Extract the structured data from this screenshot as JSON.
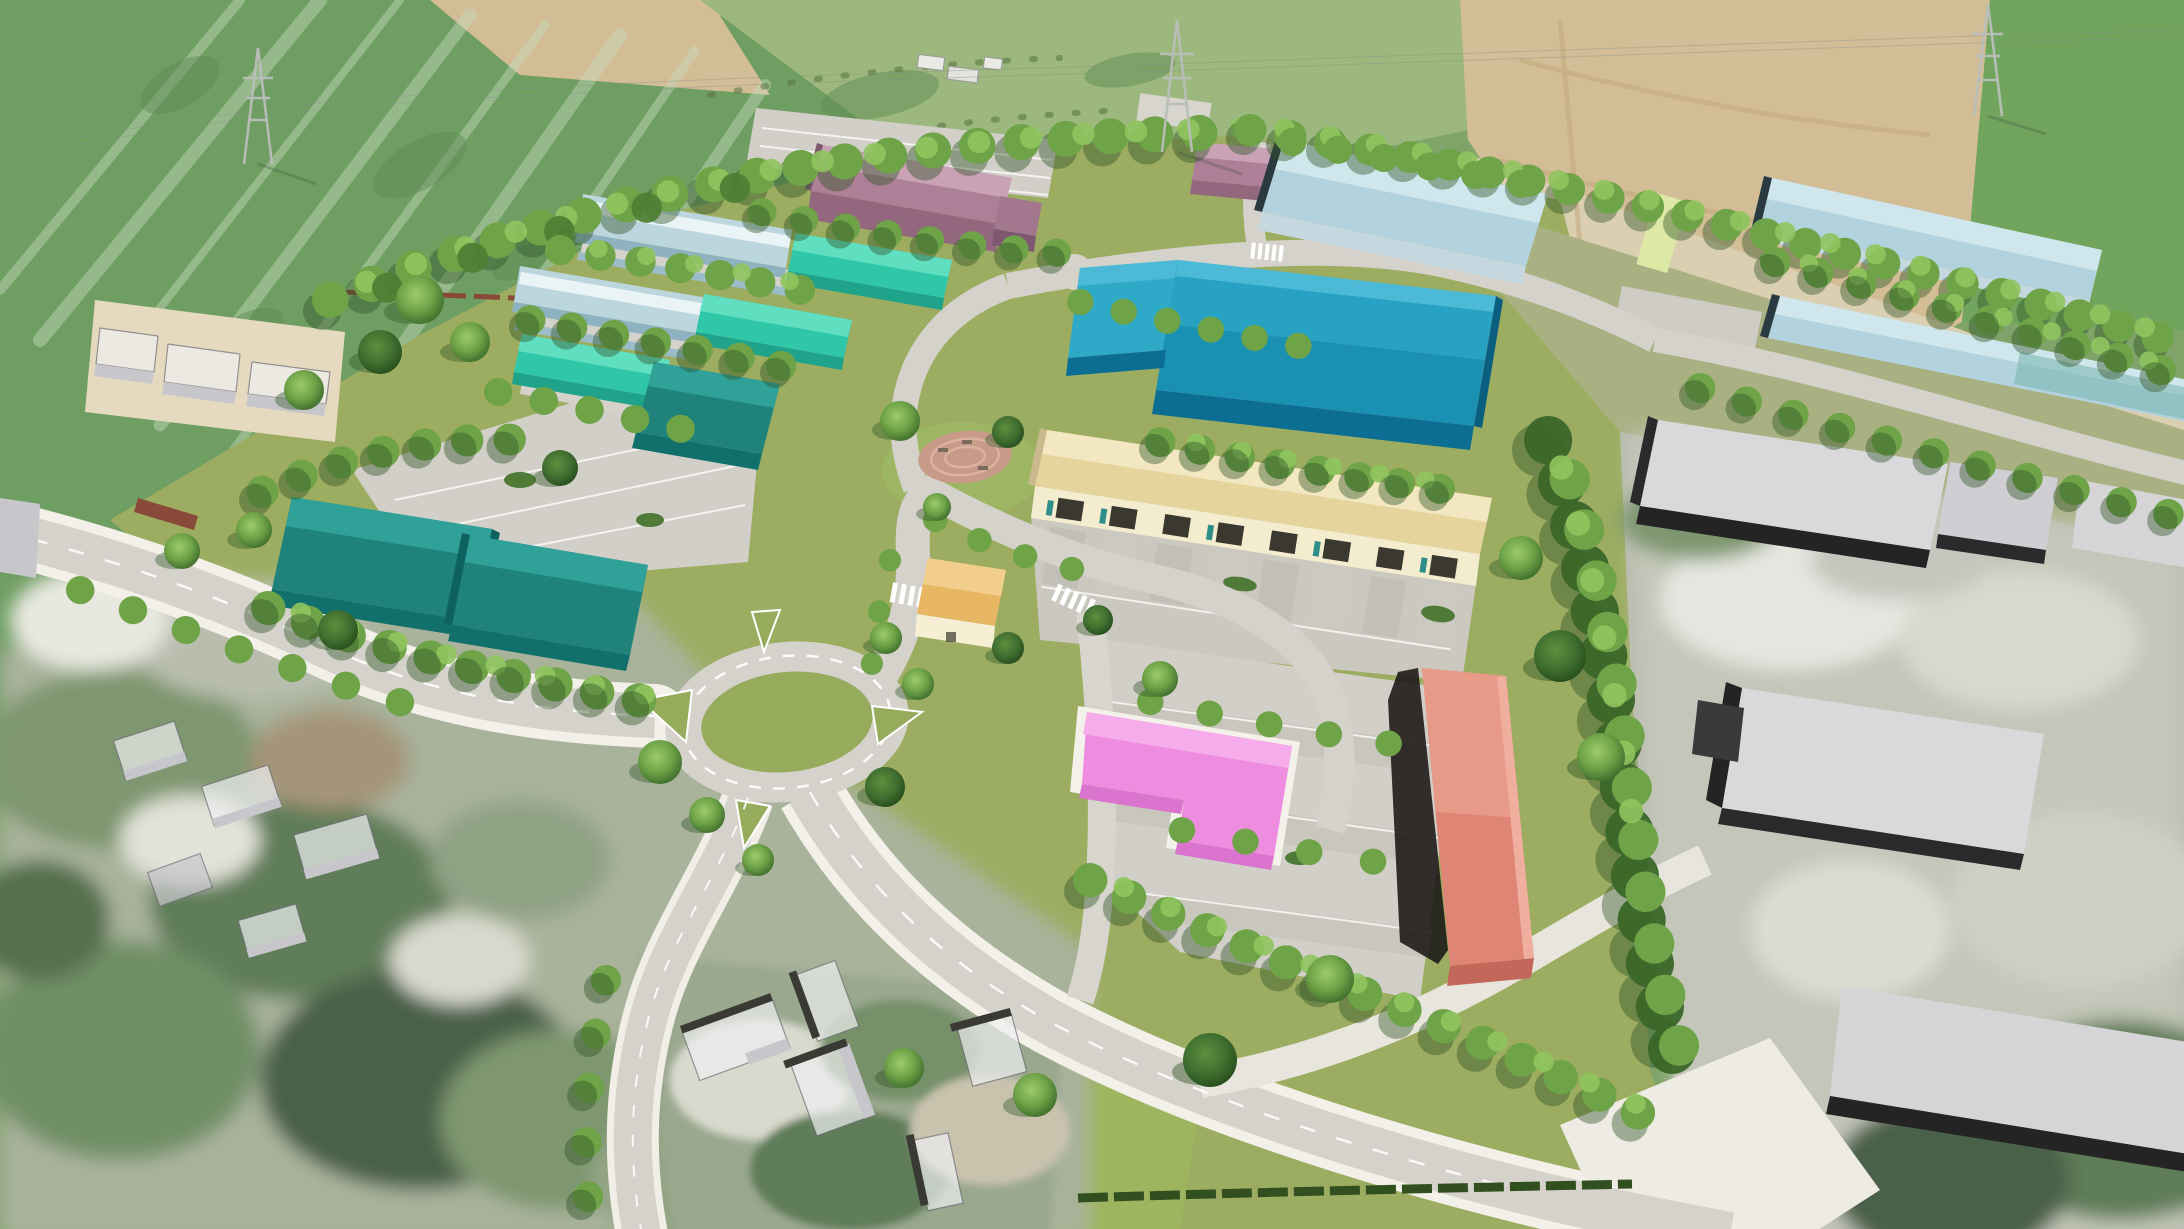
{
  "scene": {
    "type": "aerial-3d-masterplan-visualization",
    "description": "Bird's-eye photomontage of a proposed business park: colour-coded new industrial and commercial buildings set in tree-lined streets with a central roundabout, large parking courts, a circular paved plaza, three electricity pylons in surrounding farmland, existing grey industrial sheds to the east and blurred existing housing to the south-west. No text is rendered in the image.",
    "visible_text": "none"
  },
  "palette": {
    "field_green": "#7FA369",
    "field_emerald": "#6F9E63",
    "field_tan": "#D3BD96",
    "field_pale": "#DBCFB2",
    "field_bright": "#71A55E",
    "meadow": "#9CB87E",
    "site_green": "#9CAD61",
    "lb_ground": "#A9B183",
    "lawn": "#9DB55E",
    "island_green": "#96AC5C",
    "asphalt": "#D5D2CB",
    "asphalt_dark": "#CBC8C0",
    "sidewalk": "#F2F0E8",
    "apron": "#C2BFB6",
    "parking": "#D2CFC8",
    "marking": "#FFFFFF",
    "plaza_brick": "#C79B88",
    "plaza_ring": "#D9B3A2",
    "red_wall": "#8A4A3A",
    "hedge_dark": "#32501F",
    "teal_roof_light": "#2FA198",
    "teal_roof": "#1F837C",
    "teal_face": "#11706B",
    "teal_end": "#0D615E",
    "mint_roof_light": "#5FDFC0",
    "mint_roof": "#2FC7A8",
    "mint_face": "#1FA38A",
    "barrel_roof": "#BCD6DE",
    "barrel_highlight": "#EAF3F5",
    "barrel_face": "#8FB2C0",
    "blue_ridge": "#4CBAD6",
    "blue_roof_upper": "#28A2C2",
    "blue_roof_lower": "#1A90B2",
    "blue_annex": "#2FA9C8",
    "blue_face": "#0C6E93",
    "blue_end": "#0A5F80",
    "mauve_roof_light": "#C9A2B6",
    "mauve_roof": "#AE8098",
    "mauve_face": "#93687E",
    "mauve_end": "#7E5870",
    "mauve_ext": "#A3788E",
    "paleblue_roof_light": "#CFE6EC",
    "paleblue_roof": "#B2D2DD",
    "paleblue_face": "#C6D8DF",
    "paleblue_end": "#2A3A40",
    "paleblue_teal_tint": "#7FB8B4",
    "yellow_roof_light": "#F2E7C0",
    "yellow_roof": "#E5D49C",
    "yellow_face": "#F4ECCF",
    "yellow_end": "#C9B98C",
    "door_dark": "#3B382F",
    "door_teal": "#2E8F8A",
    "gold_roof_light": "#F2CE8C",
    "gold_roof": "#E8B763",
    "gold_face": "#F6EFD3",
    "pink_roof_light": "#F6ACEA",
    "pink_roof": "#EE8CDF",
    "pink_face": "#DA74CF",
    "pink_pad": "#F3F1EA",
    "salmon_roof_light": "#F0AE9E",
    "salmon_roof_upper": "#E89A89",
    "salmon_roof_lower": "#DE8576",
    "salmon_face": "#C4675B",
    "salmon_dark": "#1E1B18",
    "gray_roof": "#D9D9DB",
    "gray_roof2": "#CFCFD3",
    "gray_roof3": "#D5D5D7",
    "gray_dark": "#242424",
    "gray_side": "#2A2A2C",
    "house_roof": "#EFEFF1",
    "house_face": "#C7C7CB",
    "farm_yard": "#E5DAC0",
    "court_lime": "#DCE8A4",
    "pylon_pad": "#D8D5CE"
  },
  "buildings": [
    {
      "id": "teal-twin-west",
      "label": "twin dark-teal warehouse (west unit)",
      "color": "#1F837C"
    },
    {
      "id": "teal-twin-east",
      "label": "twin dark-teal warehouse (east unit)",
      "color": "#1F837C"
    },
    {
      "id": "teal-pair",
      "label": "dark-teal unit pair in turquoise cluster",
      "color": "#1D827C"
    },
    {
      "id": "turquoise-units",
      "label": "three bright turquoise gable units",
      "color": "#2FC7A8"
    },
    {
      "id": "pale-barrel-sheds",
      "label": "two pale-blue barrel-roof sheds",
      "color": "#BCD6DE"
    },
    {
      "id": "big-blue-warehouse",
      "label": "large petrol-blue warehouse with annex",
      "color": "#1A90B2"
    },
    {
      "id": "mauve-warehouse",
      "label": "large dusty-mauve warehouse with stepped end",
      "color": "#AE8098"
    },
    {
      "id": "mauve-small-unit",
      "label": "small mauve unit beside pylon",
      "color": "#AE8098"
    },
    {
      "id": "pale-blue-shed-1",
      "label": "pale-blue shed north-east",
      "color": "#B2D2DD"
    },
    {
      "id": "pale-blue-shed-2",
      "label": "long pale-blue shed upper far right",
      "color": "#B2D2DD"
    },
    {
      "id": "pale-blue-shed-3",
      "label": "long pale-blue shed lower far right",
      "color": "#B2D2DD"
    },
    {
      "id": "yellow-trade-terrace",
      "label": "cream-yellow trade terrace with loading doors",
      "color": "#E5D49C"
    },
    {
      "id": "golden-pavilion",
      "label": "small golden-roof pavilion",
      "color": "#E8B763"
    },
    {
      "id": "pink-retail-unit",
      "label": "bright pink L-shaped unit",
      "color": "#EE8CDF"
    },
    {
      "id": "salmon-long-building",
      "label": "long salmon building with shadowed west wall",
      "color": "#DE8576"
    },
    {
      "id": "existing-gray-industrial",
      "label": "existing grey flat-roof industrial sheds (east)",
      "color": "#D9D9DB"
    },
    {
      "id": "existing-houses",
      "label": "existing white/grey houses (south & west)",
      "color": "#EFEFF1"
    }
  ],
  "landmarks": {
    "roundabout_count": 1,
    "pylon_count": 3,
    "circular_plaza_count": 1,
    "zebra_crossing_count": 3
  }
}
